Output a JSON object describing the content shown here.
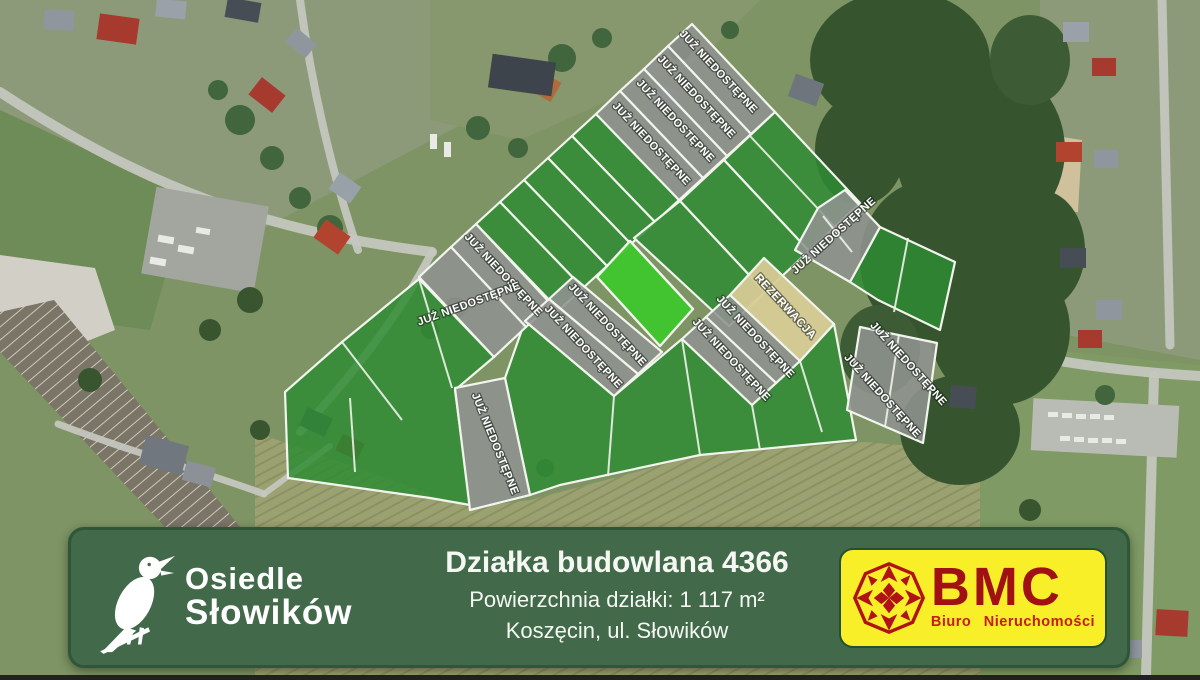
{
  "map": {
    "kind": "aerial-plot-map",
    "status_labels": {
      "unavailable": "JUŻ NIEDOSTĘPNE",
      "reserved": "REZERWACJA"
    },
    "plot_counts": {
      "unavailable_labels": 14,
      "reserved_labels": 1,
      "highlighted_plots": 1
    },
    "colors": {
      "unavailable_fill": "#90938f",
      "available_fill": "#2f8c33",
      "highlighted_fill": "#3ec62c",
      "reserved_fill": "#d8cc96",
      "boundary_line": "#f2f5ee"
    }
  },
  "banner": {
    "background_color": "#41694a",
    "estate_name_line1": "Osiedle",
    "estate_name_line2": "Słowików",
    "bird_icon": "nightingale-silhouette",
    "listing": {
      "title": "Działka budowlana 4366",
      "area_line": "Powierzchnia działki: 1 117 m²",
      "location_line": "Koszęcin, ul. Słowików"
    },
    "agency": {
      "name": "BMC",
      "subtitle": "Biuro  Nieruchomości",
      "panel_color": "#f8ef29",
      "text_color": "#a11114",
      "emblem_icon": "compass-star"
    }
  }
}
